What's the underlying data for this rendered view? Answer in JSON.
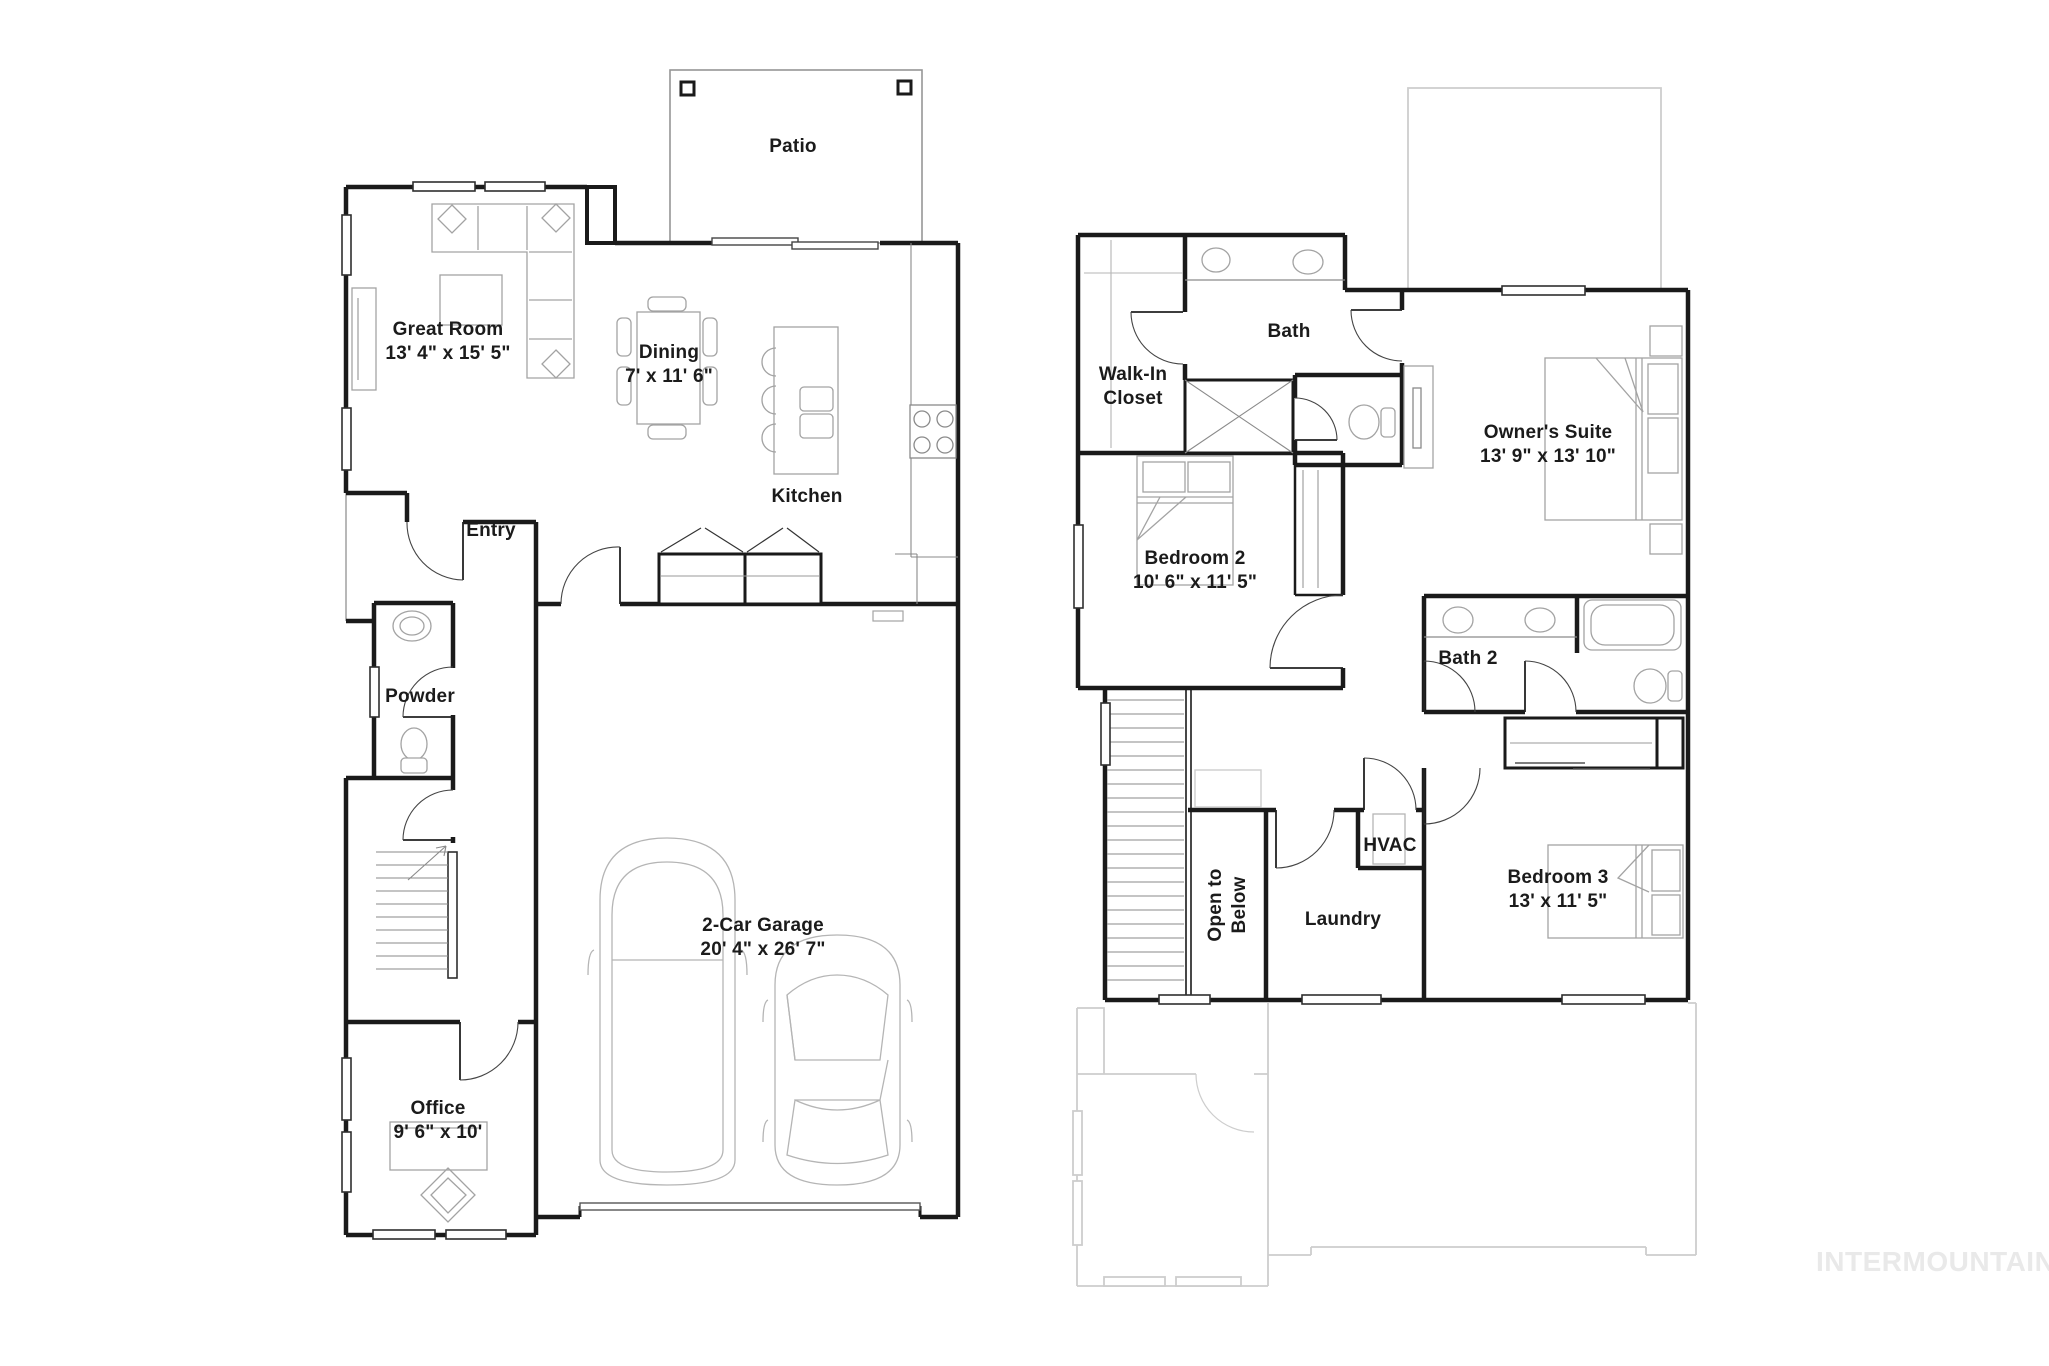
{
  "first_floor": {
    "patio": {
      "name": "Patio"
    },
    "great_room": {
      "name": "Great Room",
      "dims": "13' 4\" x 15' 5\""
    },
    "dining": {
      "name": "Dining",
      "dims": "7' x 11' 6\""
    },
    "kitchen": {
      "name": "Kitchen"
    },
    "entry": {
      "name": "Entry"
    },
    "powder": {
      "name": "Powder"
    },
    "garage": {
      "name": "2-Car Garage",
      "dims": "20' 4\" x 26' 7\""
    },
    "office": {
      "name": "Office",
      "dims": "9' 6\" x 10'"
    }
  },
  "second_floor": {
    "bath": {
      "name": "Bath"
    },
    "walk_in_closet": {
      "line1": "Walk-In",
      "line2": "Closet"
    },
    "owners_suite": {
      "name": "Owner's Suite",
      "dims": "13' 9\" x 13' 10\""
    },
    "bedroom_2": {
      "name": "Bedroom 2",
      "dims": "10' 6\" x 11' 5\""
    },
    "bath_2": {
      "name": "Bath 2"
    },
    "hvac": {
      "name": "HVAC"
    },
    "open_to_below": {
      "line1": "Open to",
      "line2": "Below"
    },
    "laundry": {
      "name": "Laundry"
    },
    "bedroom_3": {
      "name": "Bedroom 3",
      "dims": "13' x 11' 5\""
    }
  },
  "watermark": {
    "text": "INTERMOUNTAIN"
  },
  "colors": {
    "wall": "#1a1a1a",
    "furniture": "#a3a3a3",
    "ghost": "#cdcdcd",
    "watermark_text": "#e9e9e9"
  }
}
